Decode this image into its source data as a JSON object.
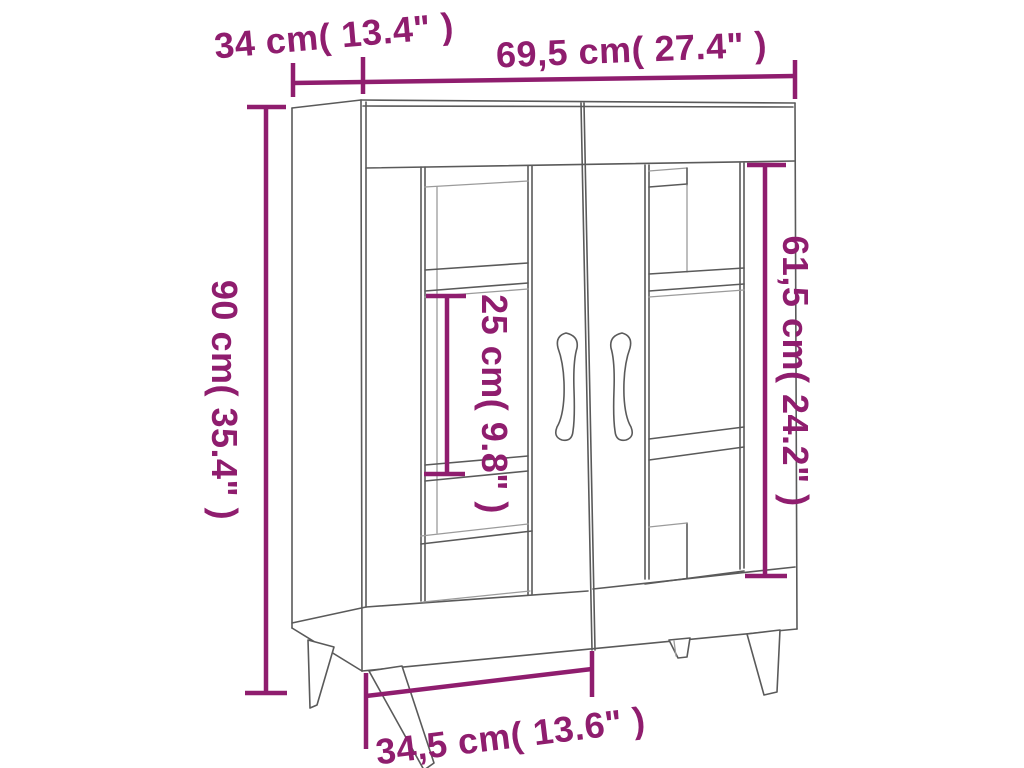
{
  "diagram": {
    "type": "product-dimension-diagram",
    "subject": "sideboard with two glass doors and tapered legs",
    "colors": {
      "dimension": "#8f1d6e",
      "outline": "#5a5a5a",
      "outline_light": "#9b9b9b",
      "background": "#ffffff"
    },
    "measurements": {
      "depth": "34 cm( 13.4\" )",
      "width": "69,5 cm( 27.4\" )",
      "height": "90 cm( 35.4\" )",
      "shelf_spacing": "25 cm( 9.8\" )",
      "door_height": "61,5 cm( 24.2\" )",
      "base_width": "34,5 cm( 13.6\" )"
    }
  }
}
